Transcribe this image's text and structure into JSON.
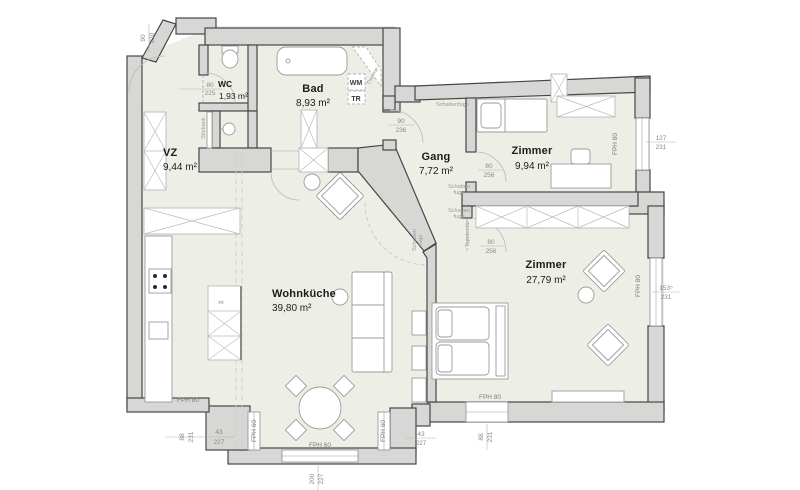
{
  "rooms": {
    "vz": {
      "name": "VZ",
      "area": "9,44 m²"
    },
    "wc": {
      "name": "WC",
      "area": "1,93 m²"
    },
    "bad": {
      "name": "Bad",
      "area": "8,93 m²"
    },
    "gang": {
      "name": "Gang",
      "area": "7,72 m²"
    },
    "zimmer_klein": {
      "name": "Zimmer",
      "area": "9,94 m²"
    },
    "zimmer_gross": {
      "name": "Zimmer",
      "area": "27,79 m²"
    },
    "wohnkueche": {
      "name": "Wohnküche",
      "area": "39,80 m²"
    }
  },
  "dimensions": {
    "entrance": {
      "w": "90",
      "h": "220"
    },
    "wc_door": {
      "w": "80",
      "h": "225"
    },
    "gang_door": {
      "w": "90",
      "h": "236"
    },
    "zimmer_klein_door": {
      "w": "80",
      "h": "256"
    },
    "tapeten_door": {
      "w": "80",
      "h": "256"
    },
    "window_right_top": {
      "w": "127",
      "h": "231"
    },
    "window_right_bottom": {
      "w": "153⁵",
      "h": "231"
    },
    "window_south": {
      "w": "88",
      "h": "231"
    },
    "window_south_small": {
      "w": "43",
      "h": "227"
    },
    "window_sw": {
      "w": "88",
      "h": "231"
    },
    "window_sw_small": {
      "w": "43",
      "h": "227"
    },
    "bay_window": {
      "w": "200",
      "h": "227"
    }
  },
  "annotations": {
    "fph80": "FPH 80",
    "fph60": "FPH 60",
    "schattenfuge": "Schattenfuge",
    "schatten": "Schatten",
    "fuge": "fuge",
    "sitzbank": "Sitzbank",
    "therme": "Therme",
    "wm": "WM",
    "tr": "TR",
    "tapetentuer": "Tapetentür",
    "kitchen_marker": "⋈"
  },
  "colors": {
    "floor": "#edefe6",
    "wall_fill": "#d7d7d5",
    "wall_stroke": "#474747",
    "furniture_stroke": "#9b9b9b"
  }
}
